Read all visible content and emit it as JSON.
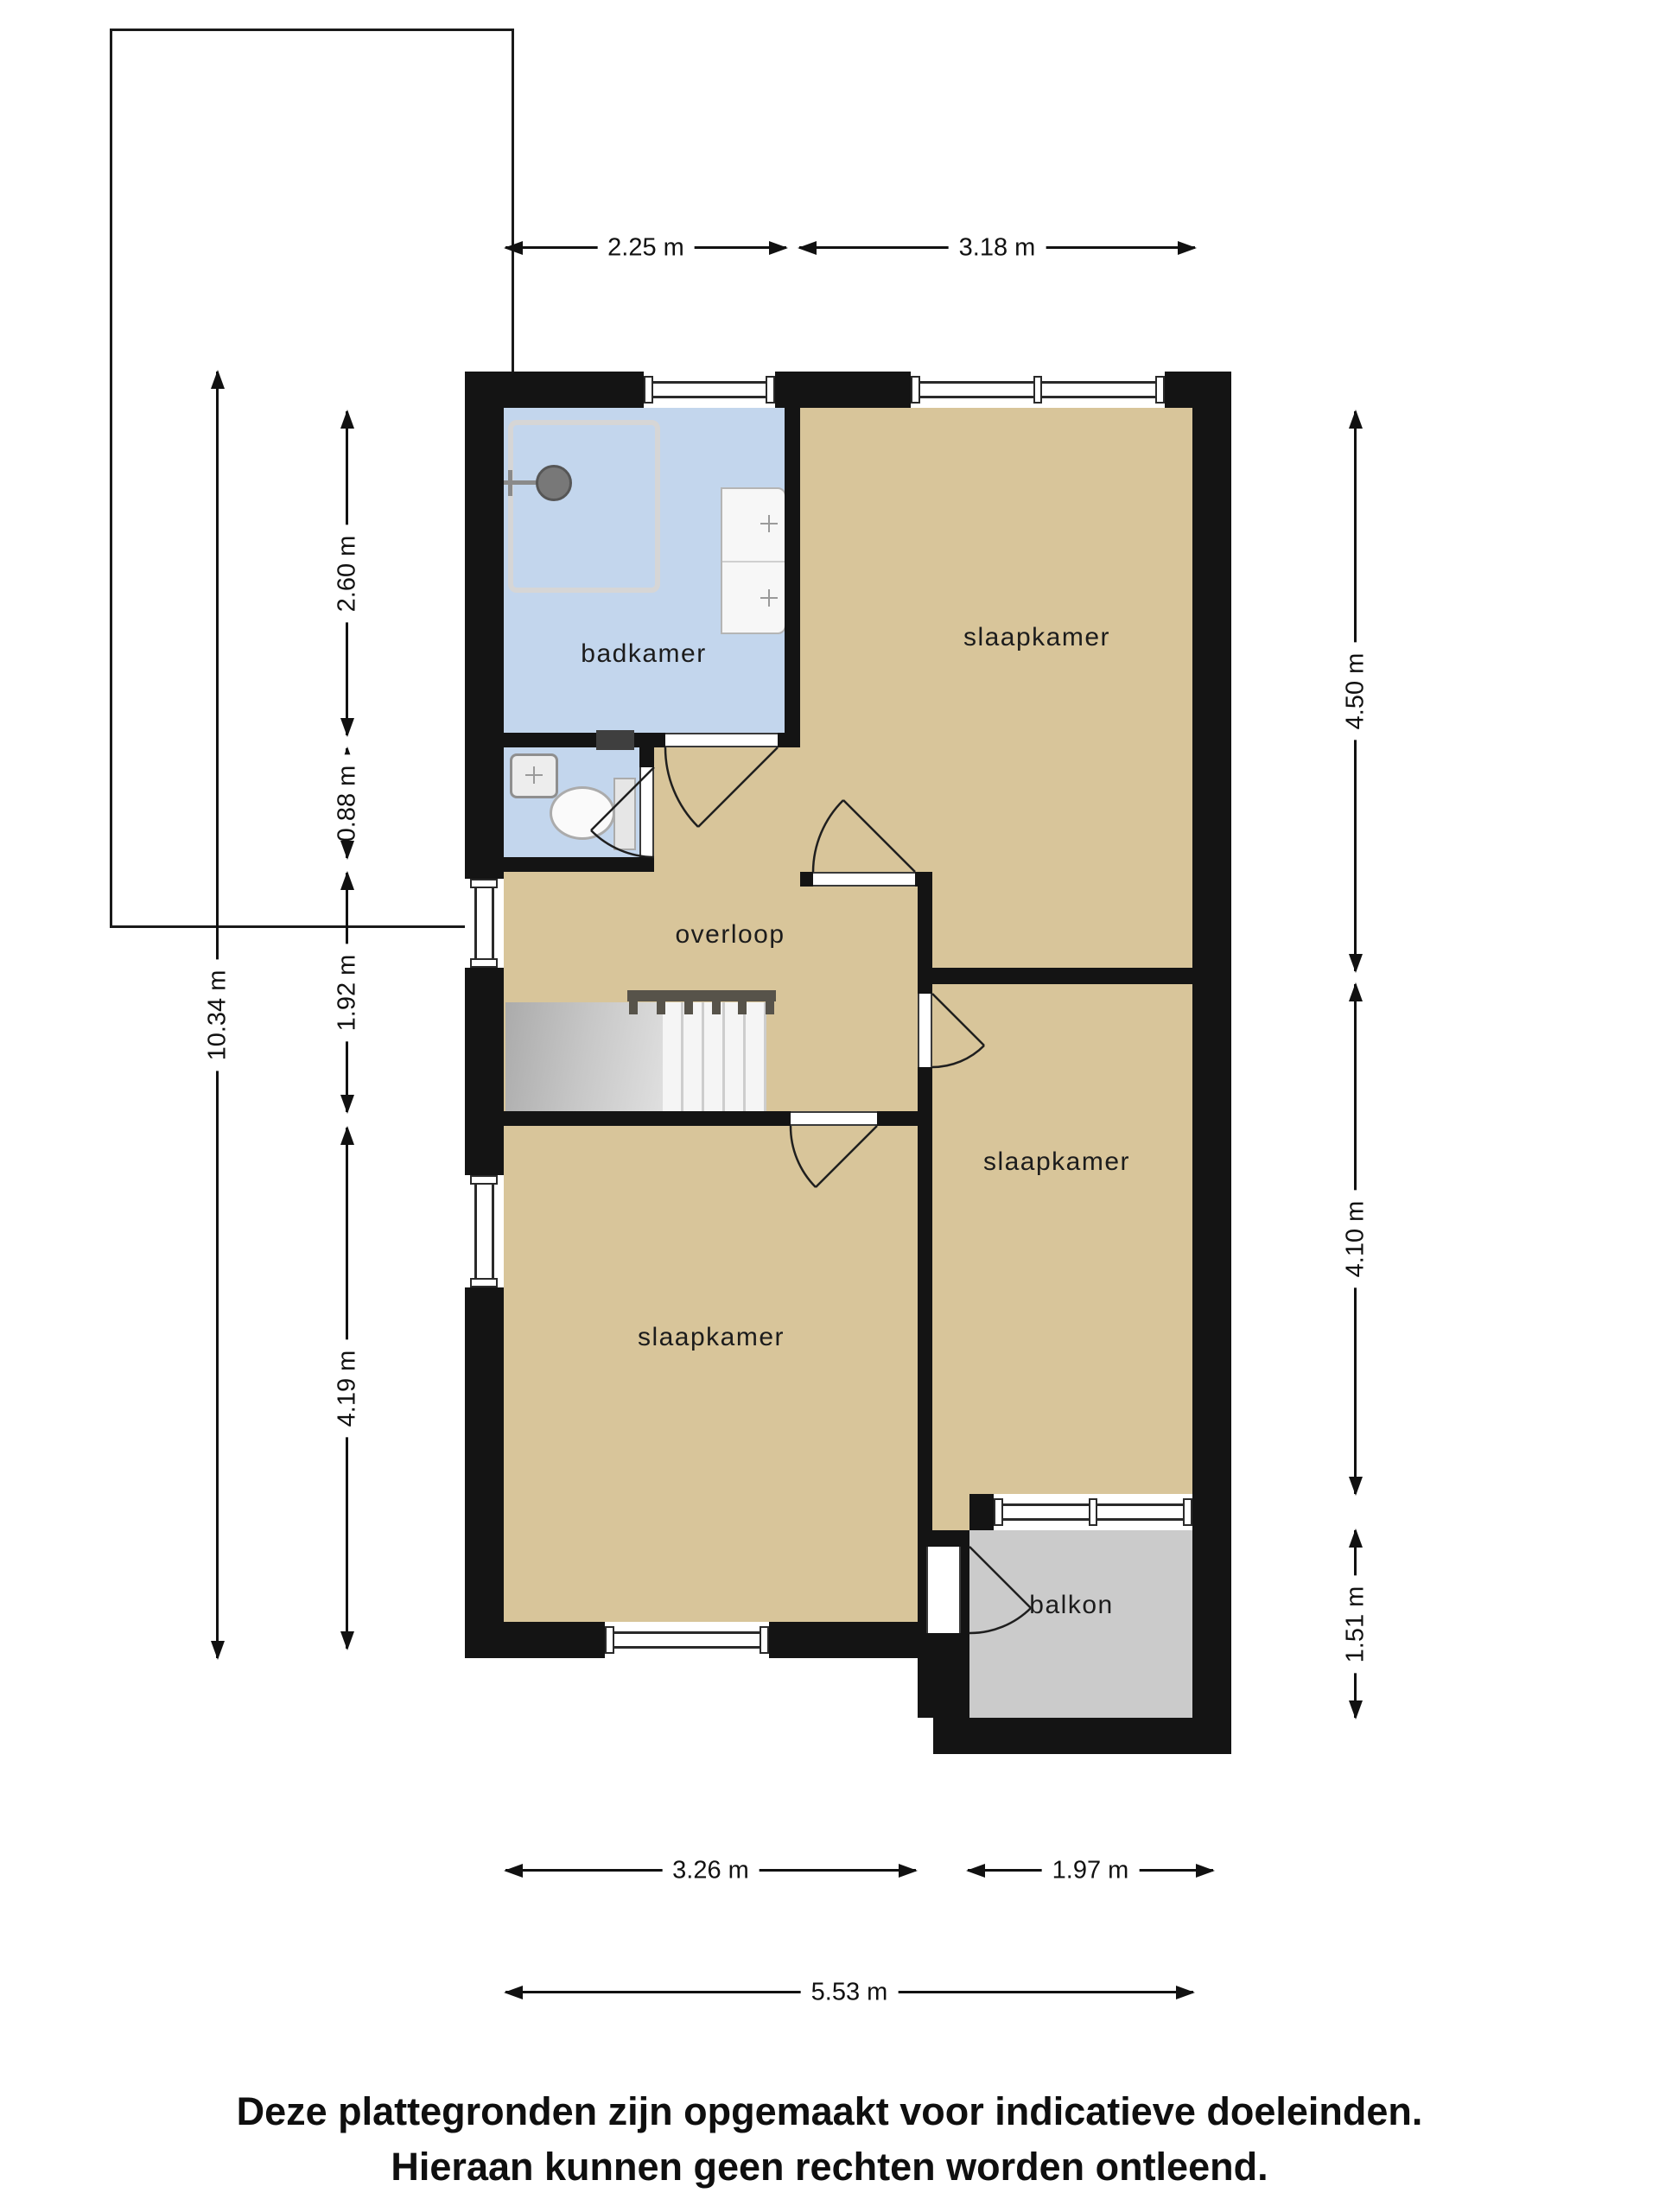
{
  "plan": {
    "rooms": [
      {
        "id": "badkamer",
        "label": "badkamer"
      },
      {
        "id": "slaapkamer-top",
        "label": "slaapkamer"
      },
      {
        "id": "overloop",
        "label": "overloop"
      },
      {
        "id": "slaapkamer-mid",
        "label": "slaapkamer"
      },
      {
        "id": "slaapkamer-bottom",
        "label": "slaapkamer"
      },
      {
        "id": "balkon",
        "label": "balkon"
      }
    ],
    "dimensions": {
      "top": [
        {
          "label": "2.25 m"
        },
        {
          "label": "3.18 m"
        }
      ],
      "left_outer": [
        {
          "label": "10.34 m"
        }
      ],
      "left_inner": [
        {
          "label": "2.60 m"
        },
        {
          "label": "0.88 m"
        },
        {
          "label": "1.92 m"
        },
        {
          "label": "4.19 m"
        }
      ],
      "right": [
        {
          "label": "4.50 m"
        },
        {
          "label": "4.10 m"
        },
        {
          "label": "1.51 m"
        }
      ],
      "bottom_inner": [
        {
          "label": "3.26 m"
        },
        {
          "label": "1.97 m"
        }
      ],
      "bottom_total": [
        {
          "label": "5.53 m"
        }
      ]
    },
    "disclaimer": {
      "line1": "Deze plattegronden zijn opgemaakt voor indicatieve doeleinden.",
      "line2": "Hieraan kunnen geen rechten worden ontleend."
    },
    "colors": {
      "wall": "#141414",
      "floor": "#D8C59A",
      "bathroom": "#C3D6ED",
      "balcony": "#CBCBCB",
      "stairs_railing": "#57534A"
    }
  }
}
